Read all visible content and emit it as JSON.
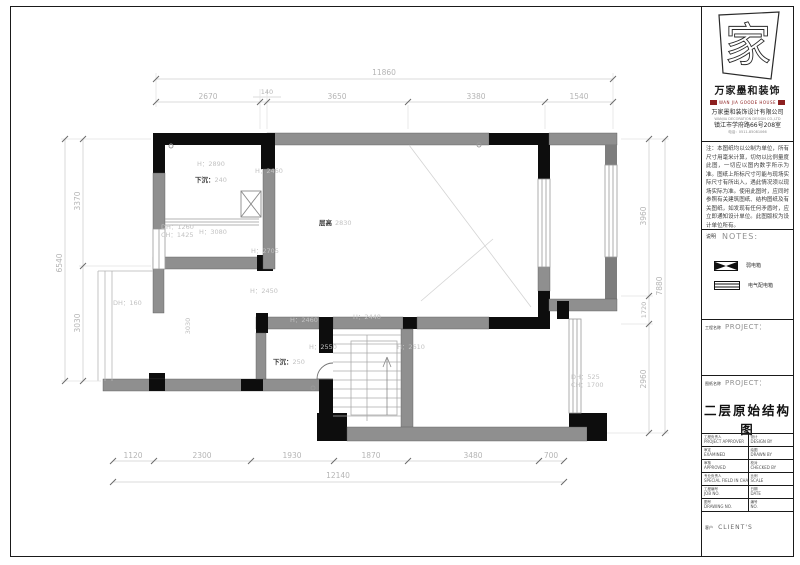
{
  "colors": {
    "wall_black": "#0d0d0d",
    "wall_gray": "#8f8f8f",
    "dim_text": "#b5b5b5",
    "accent_red": "#8d2020"
  },
  "plan": {
    "dims": {
      "top_total": "11860",
      "top_segments": [
        "2670",
        "140",
        "3650",
        "3380",
        "1540"
      ],
      "left_total": "6540",
      "left_segments": [
        "3370",
        "3030"
      ],
      "right_total": "7880",
      "right_segments": [
        "3960",
        "1720",
        "2960"
      ],
      "bottom_total": "12140",
      "bottom_segments": [
        "1120",
        "2300",
        "1930",
        "1870",
        "3480",
        "700"
      ]
    },
    "labels": {
      "h_topleft": "H：2890",
      "sunken_a_label": "下沉：",
      "sunken_a_value": "240",
      "h_flue": "H：2460",
      "dh_left": "DH：1260",
      "ch_left": "CH：1425",
      "h_3080": "H：3080",
      "h_2705": "H：2705",
      "ceiling_label": "层高",
      "ceiling_value": "2830",
      "dh_160": "DH：160",
      "dim_3030": "3030",
      "h_2450": "H：2450",
      "h_2460_b": "H：2460",
      "h_2440": "H：2440",
      "h_2550": "H：2550",
      "sunken_b_label": "下沉：",
      "sunken_b_value": "250",
      "h_2610": "H：2610",
      "dh_525": "DH：525",
      "ch_1700": "CH：1700"
    }
  },
  "title_block": {
    "logo_char": "家",
    "brand_cn": "万家墨和装饰",
    "brand_en": "WAN JIA GOODE HOUSE",
    "company_cn": "万家墨和装饰设计有限公司",
    "company_en": "WANJIA DECORATION DESIGN CO.,LTD",
    "address": "镇江市学府路66号208室",
    "phone": "电话：0511-85081066",
    "note": "注：本图纸均以公制为单位，所有尺寸用毫米计算，切勿以比例量度此图，一切应以图内数字所示为准。图纸上所标尺寸可能与现场实际尺寸有所出入，遇此情况须以现场实际为准。使用此图时，应同时参照有关建筑图纸、结构图纸及有关图纸，如发现有任何矛盾时，应立即通知设计单位。此图版权为设计单位所有。",
    "notes_cn": "说明",
    "notes_en": "NOTES:",
    "legend": [
      {
        "label": "弱电箱"
      },
      {
        "label": "电气配电箱"
      }
    ],
    "project_cn": "工程名称",
    "project_en": "PROJECT：",
    "drawing_cn": "图纸名称",
    "drawing_en": "PROJECT：",
    "drawing_title": "二层原始结构图",
    "table": [
      {
        "lcn": "工程负责人",
        "len": "PROJECT APPROVER",
        "rcn": "设计",
        "ren": "DESIGN BY"
      },
      {
        "lcn": "审定",
        "len": "EXAMINED",
        "rcn": "绘图",
        "ren": "DRAWN BY"
      },
      {
        "lcn": "审核",
        "len": "APPROVED",
        "rcn": "校对",
        "ren": "CHECKED BY"
      },
      {
        "lcn": "专业负责人",
        "len": "SPECIAL FIELD IN CHARGE",
        "rcn": "比例",
        "ren": "SCALE"
      },
      {
        "lcn": "工程编号",
        "len": "JOB NO.",
        "rcn": "日期",
        "ren": "DATE"
      },
      {
        "lcn": "图号",
        "len": "DRAWING NO.",
        "rcn": "编号",
        "ren": "NO."
      }
    ],
    "client_cn": "客户",
    "client_en": "CLIENT'S"
  }
}
